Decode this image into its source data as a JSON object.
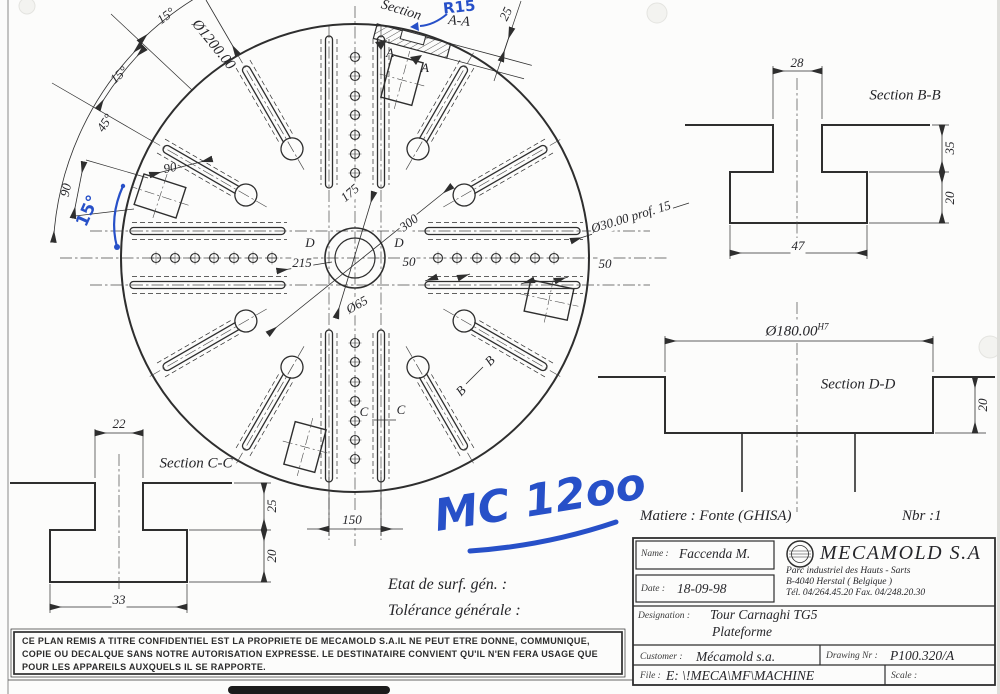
{
  "colors": {
    "ink": "#2e2e2e",
    "blue_pen": "#2750c8",
    "paper": "#fcfcfb"
  },
  "main_view": {
    "dim_d1200": "Ø1200.00",
    "dim_a15_1": "15°",
    "dim_a15_2": "15°",
    "dim_a45": "45°",
    "dim_90_1": "90",
    "dim_90_2": "90",
    "dim_175": "175",
    "dim_300": "300",
    "dim_215": "215",
    "dim_50_1": "50",
    "dim_50_2": "50",
    "dim_65": "Ø65",
    "dim_30": "Ø30.00  prof. 15",
    "dim_150": "150",
    "dim_25": "25",
    "section_aa_1": "Section",
    "section_aa_2": "A-A",
    "lbl_a1": "A",
    "lbl_a2": "A",
    "lbl_b1": "B",
    "lbl_b2": "B",
    "lbl_c1": "C",
    "lbl_c2": "C",
    "lbl_d1": "D",
    "lbl_d2": "D"
  },
  "blue_notes": {
    "r15": "R15",
    "a15": "15°",
    "mc": "MC 12oo"
  },
  "section_bb": {
    "title": "Section B-B",
    "dim_top": "28",
    "dim_upper": "35",
    "dim_lower": "20",
    "dim_bottom": "47"
  },
  "section_cc": {
    "title": "Section C-C",
    "dim_top": "22",
    "dim_upper": "25",
    "dim_lower": "20",
    "dim_bottom": "33"
  },
  "section_dd": {
    "title": "Section D-D",
    "dim_dia": "Ø180.00",
    "dim_tol": "H7",
    "dim_depth": "20"
  },
  "notes": {
    "surface": "Etat de surf. gén. :",
    "tolerance": "Tolérance générale :",
    "material": "Matiere : Fonte (GHISA)",
    "quantity": "Nbr :1"
  },
  "confidentiality": {
    "line1": "CE PLAN REMIS A TITRE CONFIDENTIEL EST LA PROPRIETE DE MECAMOLD S.A.IL NE PEUT ETRE DONNE, COMMUNIQUE,",
    "line2": "COPIE OU DECALQUE SANS NOTRE AUTORISATION EXPRESSE. LE DESTINATAIRE CONVIENT QU'IL N'EN FERA USAGE QUE",
    "line3": "POUR LES APPAREILS AUXQUELS IL SE RAPPORTE."
  },
  "title_block": {
    "name_label": "Name :",
    "name_value": "Faccenda M.",
    "date_label": "Date :",
    "date_value": "18-09-98",
    "company": "MECAMOLD  S.A",
    "address1": "Parc industriel des Hauts - Sarts",
    "address2": "B-4040    Herstal   ( Belgique )",
    "address3": "Tél. 04/264.45.20    Fax. 04/248.20.30",
    "designation_label": "Designation :",
    "designation_value1": "Tour Carnaghi TG5",
    "designation_value2": "Plateforme",
    "customer_label": "Customer :",
    "customer_value": "Mécamold s.a.",
    "drawing_label": "Drawing Nr :",
    "drawing_value": "P100.320/A",
    "file_label": "File :",
    "file_value": "E: \\!MECA\\MF\\MACHINE",
    "scale_label": "Scale :"
  }
}
